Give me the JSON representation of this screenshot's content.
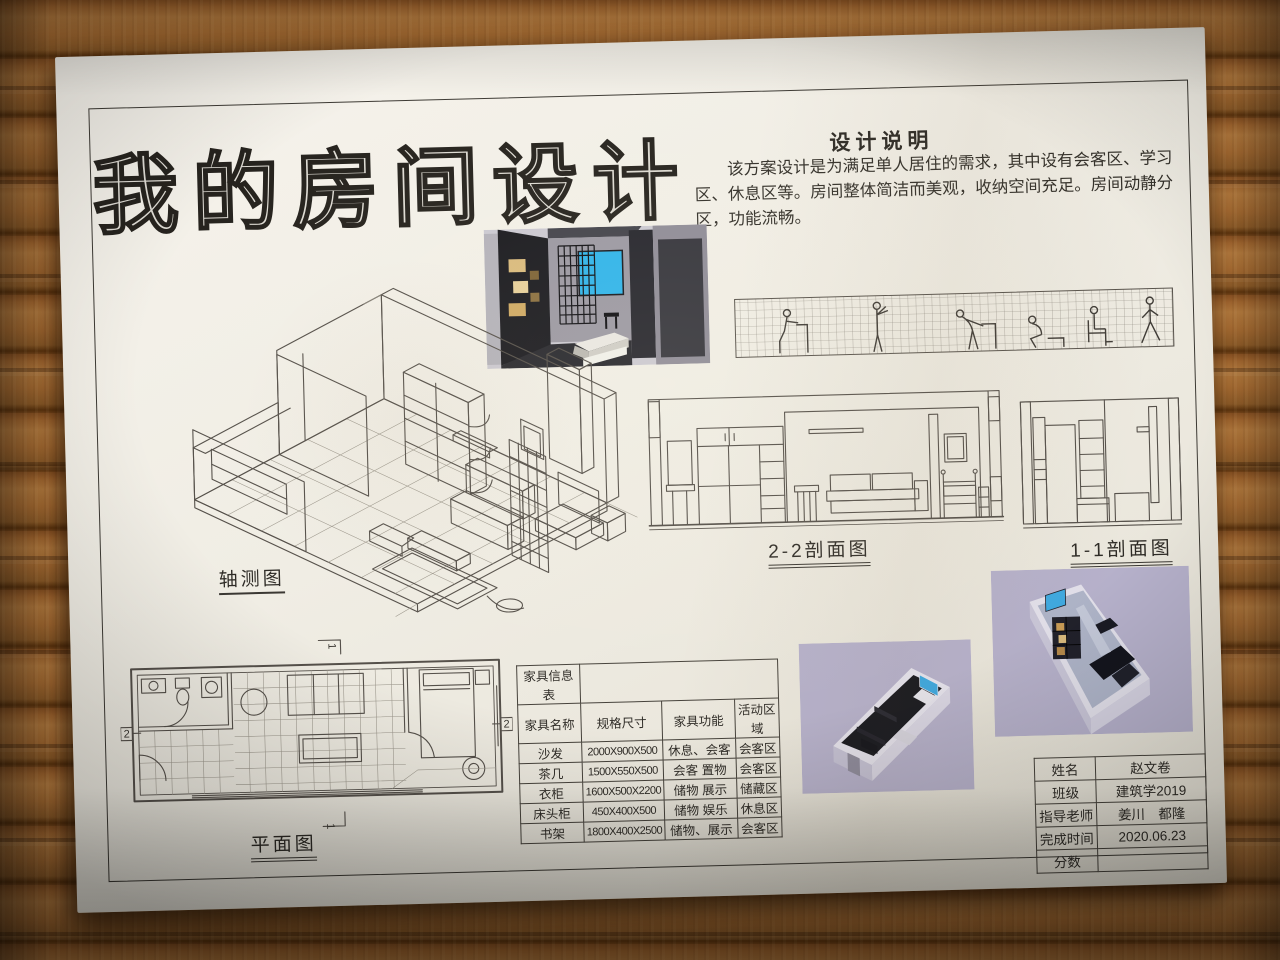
{
  "poster": {
    "title": "我的房间设计",
    "design_notes": {
      "heading": "设计说明",
      "body": "该方案设计是为满足单人居住的需求，其中设有会客区、学习区、休息区等。房间整体简洁而美观，收纳空间充足。房间动静分区，功能流畅。"
    },
    "drawing_labels": {
      "axonometric": "轴测图",
      "section_2_2": "2-2剖面图",
      "section_1_1": "1-1剖面图",
      "floor_plan": "平面图"
    },
    "plan_section_markers": {
      "section_2": "2",
      "section_1": "1"
    },
    "furniture_table": {
      "title": "家具信息表",
      "headers": [
        "家具名称",
        "规格尺寸",
        "家具功能",
        "活动区域"
      ],
      "rows": [
        [
          "沙发",
          "2000X900X500",
          "休息、会客",
          "会客区"
        ],
        [
          "茶几",
          "1500X550X500",
          "会客 置物",
          "会客区"
        ],
        [
          "衣柜",
          "1600X500X2200",
          "储物 展示",
          "储藏区"
        ],
        [
          "床头柜",
          "450X400X500",
          "储物 娱乐",
          "休息区"
        ],
        [
          "书架",
          "1800X400X2500",
          "储物、展示",
          "会客区"
        ]
      ]
    },
    "title_block": {
      "name_label": "姓名",
      "name_value": "赵文卷",
      "class_label": "班级",
      "class_value": "建筑学2019",
      "teacher_label": "指导老师",
      "teacher_value": "姜川　都隆",
      "time_label": "完成时间",
      "time_value": "2020.06.23",
      "score_label": "分数",
      "score_value": ""
    },
    "colors": {
      "paper": "#f0ede4",
      "wood_plank": "#9a5f2a",
      "window_blue": "#2fb4ea",
      "render_background_lavender": "#b7b2cc",
      "shelf_box_tan": "#d9ba7d",
      "render_dark_wall": "#17171b"
    }
  }
}
